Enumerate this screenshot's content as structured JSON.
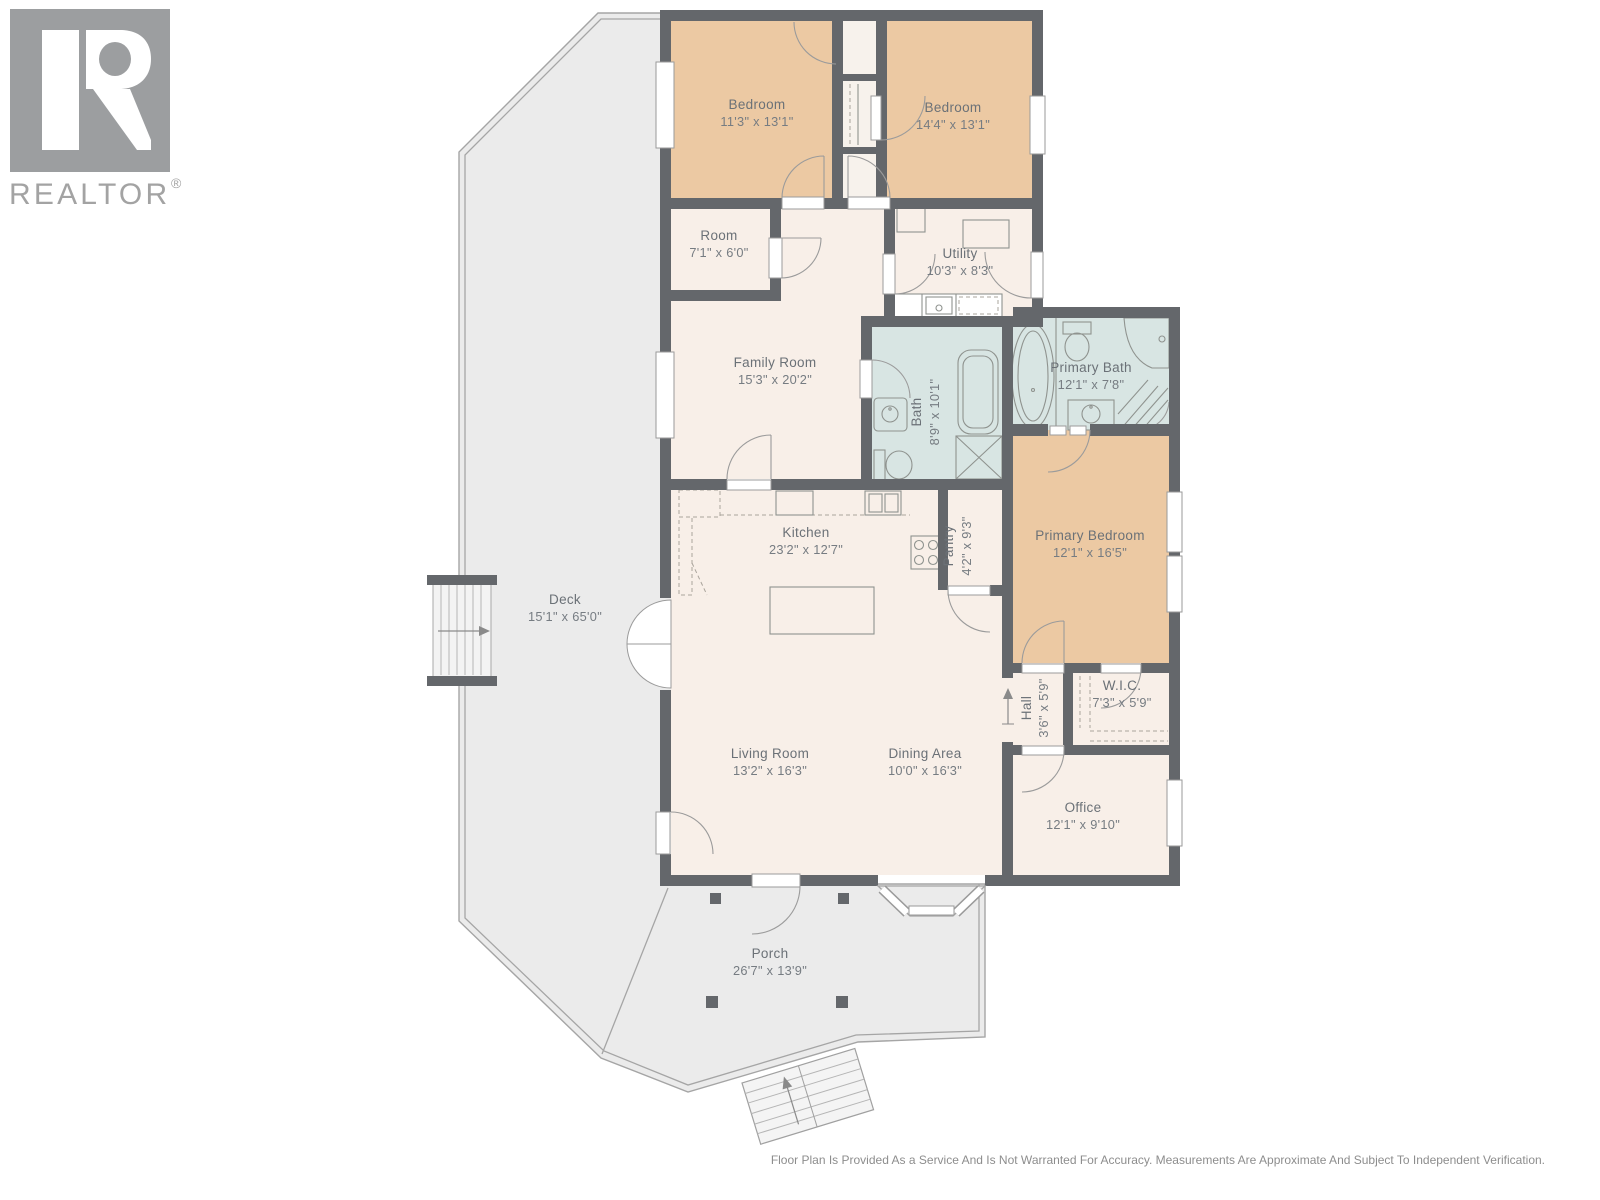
{
  "logo": {
    "brand": "REALTOR",
    "registered": "®"
  },
  "rooms": {
    "bedroom_1": {
      "name": "Bedroom",
      "dims": "11'3\" x 13'1\""
    },
    "bedroom_2": {
      "name": "Bedroom",
      "dims": "14'4\" x 13'1\""
    },
    "room": {
      "name": "Room",
      "dims": "7'1\" x 6'0\""
    },
    "utility": {
      "name": "Utility",
      "dims": "10'3\" x 8'3\""
    },
    "family_room": {
      "name": "Family Room",
      "dims": "15'3\" x 20'2\""
    },
    "bath": {
      "name": "Bath",
      "dims": "8'9\" x 10'1\""
    },
    "primary_bath": {
      "name": "Primary Bath",
      "dims": "12'1\" x 7'8\""
    },
    "primary_bedroom": {
      "name": "Primary Bedroom",
      "dims": "12'1\" x 16'5\""
    },
    "kitchen": {
      "name": "Kitchen",
      "dims": "23'2\" x 12'7\""
    },
    "pantry": {
      "name": "Pantry",
      "dims": "4'2\" x 9'3\""
    },
    "deck": {
      "name": "Deck",
      "dims": "15'1\" x 65'0\""
    },
    "hall": {
      "name": "Hall",
      "dims": "3'6\" x 5'9\""
    },
    "wic": {
      "name": "W.I.C.",
      "dims": "7'3\" x 5'9\""
    },
    "living_room": {
      "name": "Living Room",
      "dims": "13'2\" x 16'3\""
    },
    "dining_area": {
      "name": "Dining Area",
      "dims": "10'0\" x 16'3\""
    },
    "office": {
      "name": "Office",
      "dims": "12'1\" x 9'10\""
    },
    "porch": {
      "name": "Porch",
      "dims": "26'7\" x 13'9\""
    }
  },
  "footer": {
    "disclaimer": "Floor Plan Is Provided As a Service And Is Not Warranted For Accuracy. Measurements Are Approximate And Subject To Independent Verification."
  },
  "colors": {
    "wall": "#64676b",
    "bedroom_fill": "#ecc9a3",
    "bath_fill": "#d8e5e3",
    "room_fill": "#f8efe8",
    "outdoor_fill": "#ebebeb",
    "label_text": "#6b7177"
  }
}
